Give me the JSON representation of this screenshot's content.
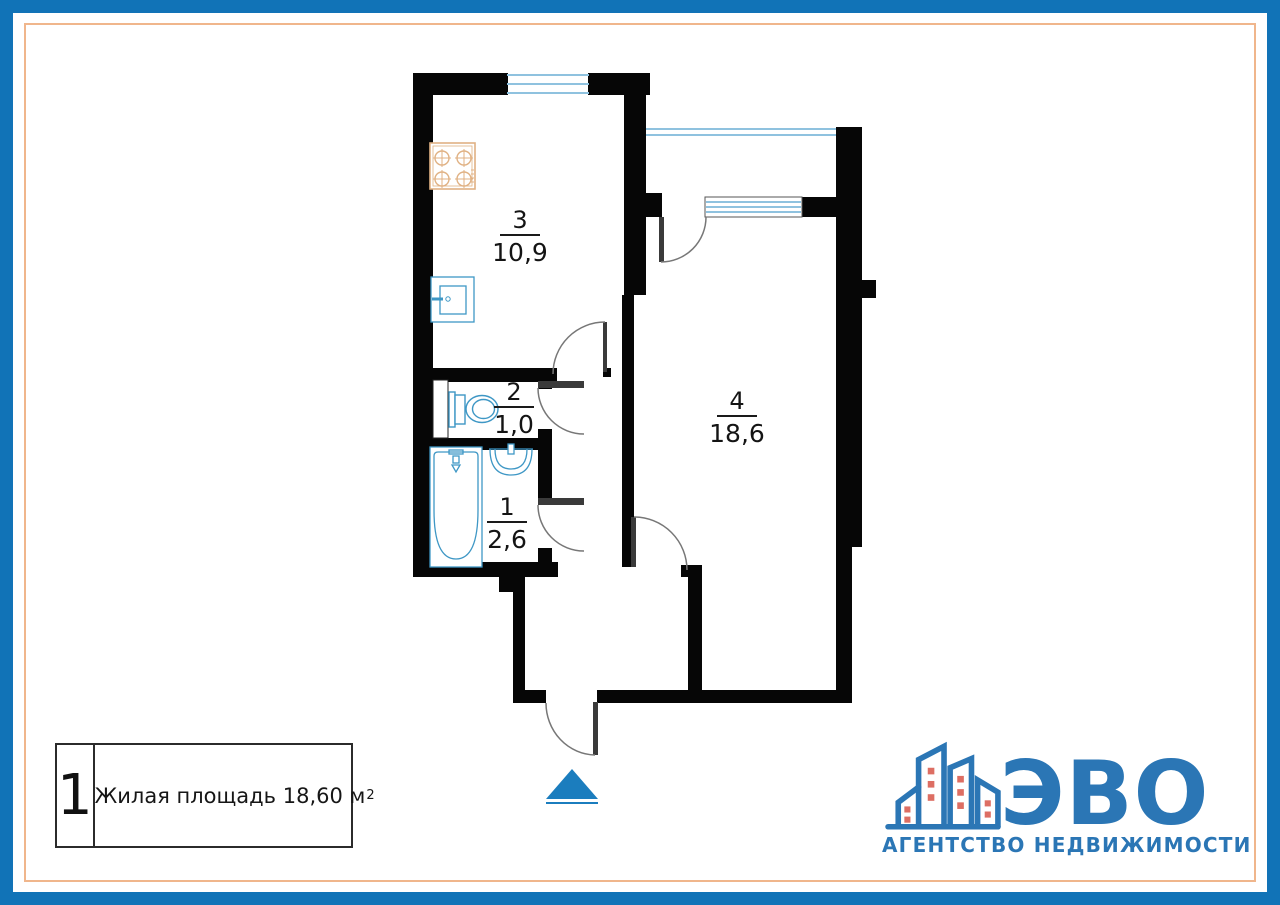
{
  "frame": {
    "outer_border_color": "#1173B7",
    "inner_line_color": "#F0B68C"
  },
  "floor_plan": {
    "rooms": [
      {
        "key": "kitchen",
        "number": "3",
        "area": "10,9"
      },
      {
        "key": "toilet",
        "number": "2",
        "area": "1,0"
      },
      {
        "key": "bathroom",
        "number": "1",
        "area": "2,6"
      },
      {
        "key": "living-room",
        "number": "4",
        "area": "18,6"
      }
    ],
    "colors": {
      "wall": "#060606",
      "window": "#8FC2DF",
      "fixture": "#3E97C5",
      "stove": "#E0B183",
      "door": "#777777",
      "leaf": "#3a3a3a",
      "arrow": "#1B7DBE"
    }
  },
  "legend": {
    "flat_number": "1",
    "area_label": "Жилая площадь 18,60 м",
    "area_sup": "2"
  },
  "logo": {
    "title": "ЭВО",
    "subtitle": "АГЕНТСТВО НЕДВИЖИМОСТИ",
    "brand_color": "#2B76B5",
    "window_color": "#DD6E63"
  }
}
